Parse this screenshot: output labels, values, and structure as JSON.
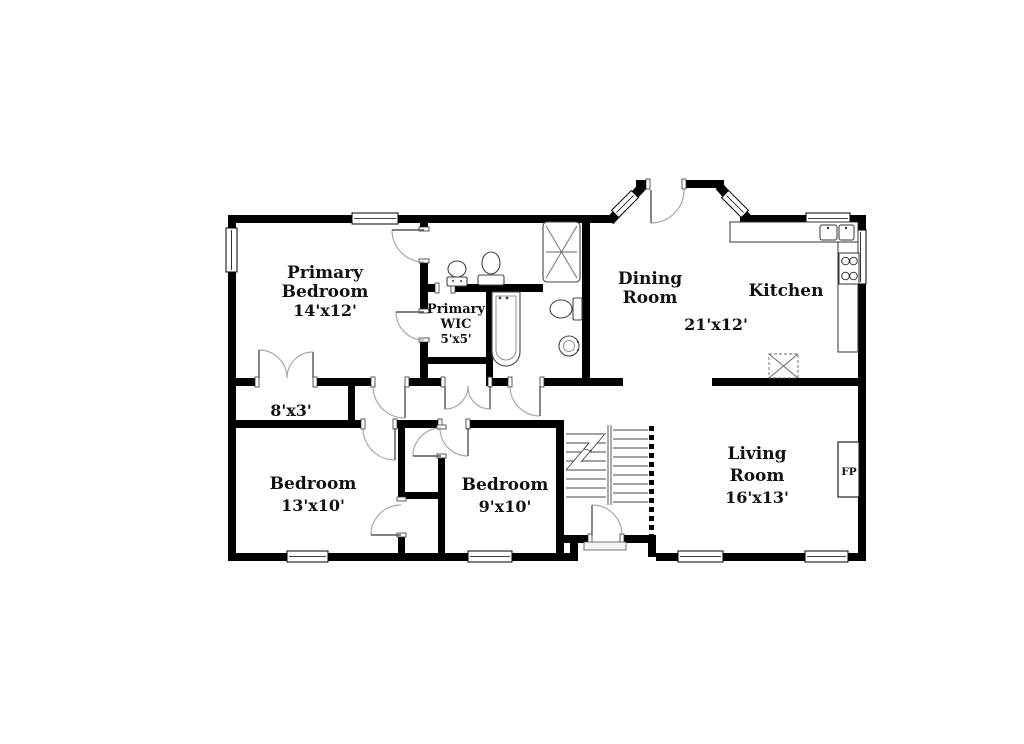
{
  "rooms": {
    "primary_bedroom": {
      "line1": "Primary",
      "line2": "Bedroom",
      "dims": "14'x12'"
    },
    "primary_wic": {
      "line1": "Primary",
      "line2": "WIC",
      "dims": "5'x5'"
    },
    "dining_room": {
      "line1": "Dining",
      "line2": "Room"
    },
    "dining_kitchen_dims": "21'x12'",
    "kitchen": {
      "name": "Kitchen"
    },
    "living_room": {
      "line1": "Living",
      "line2": "Room",
      "dims": "16'x13'"
    },
    "bedroom_13": {
      "name": "Bedroom",
      "dims": "13'x10'"
    },
    "bedroom_9": {
      "name": "Bedroom",
      "dims": "9'x10'"
    },
    "hall_closet": {
      "dims": "8'x3'"
    },
    "fireplace": {
      "abbr": "FP"
    }
  },
  "colors": {
    "wall": "#000000",
    "background": "#ffffff",
    "door_arc": "#a8a8a8",
    "fixture_outline": "#444444"
  }
}
